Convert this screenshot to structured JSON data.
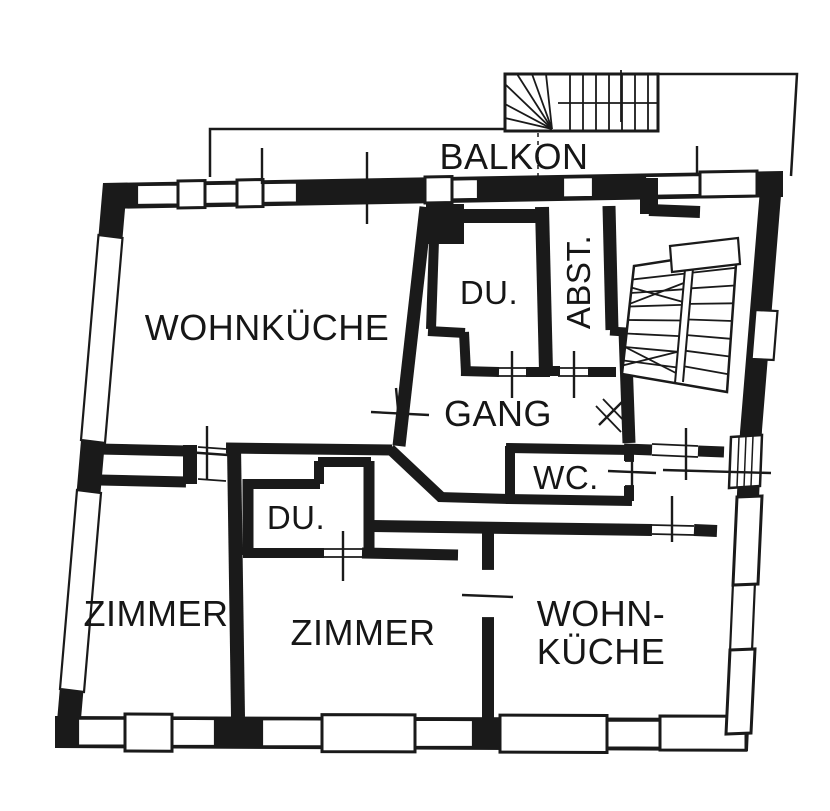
{
  "title": "apartment floor plan",
  "colors": {
    "ink": "#1a1a1a",
    "paper": "#ffffff"
  },
  "rooms": {
    "balkon": "BALKON",
    "wohnkueche_top": "WOHNKÜCHE",
    "du_top": "DU.",
    "abst": "ABST.",
    "gang": "GANG",
    "wc": "WC.",
    "du_bottom": "DU.",
    "zimmer_left": "ZIMMER",
    "zimmer_center": "ZIMMER",
    "wohnkueche_bottom_line1": "WOHN-",
    "wohnkueche_bottom_line2": "KÜCHE"
  }
}
